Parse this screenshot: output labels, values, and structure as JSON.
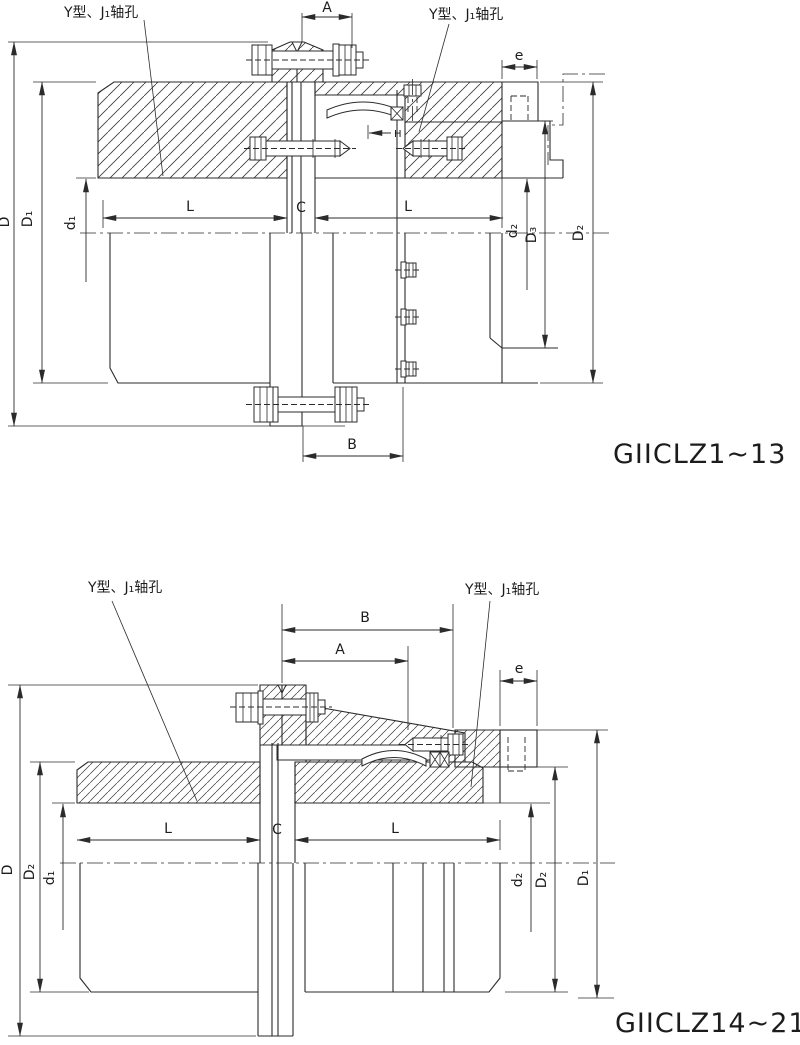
{
  "colors": {
    "line": "#2b2b2b",
    "background": "#ffffff"
  },
  "figures": [
    {
      "title": "GIICLZ1~13",
      "shaft_label_left": "Y型、J₁轴孔",
      "shaft_label_right": "Y型、J₁轴孔",
      "dims": {
        "A": "A",
        "B": "B",
        "C": "C",
        "D": "D",
        "D1": "D₁",
        "d1": "d₁",
        "L_left": "L",
        "L_right": "L",
        "d2": "d₂",
        "D3": "D₃",
        "D2": "D₂",
        "e": "e",
        "H": "H"
      }
    },
    {
      "title": "GIICLZ14~21",
      "shaft_label_left": "Y型、J₁轴孔",
      "shaft_label_right": "Y型、J₁轴孔",
      "dims": {
        "A": "A",
        "B": "B",
        "C": "C",
        "D": "D",
        "D2_left": "D₂",
        "d1": "d₁",
        "L_left": "L",
        "L_right": "L",
        "d2": "d₂",
        "D2_right": "D₂",
        "D1": "D₁",
        "e": "e"
      }
    }
  ]
}
